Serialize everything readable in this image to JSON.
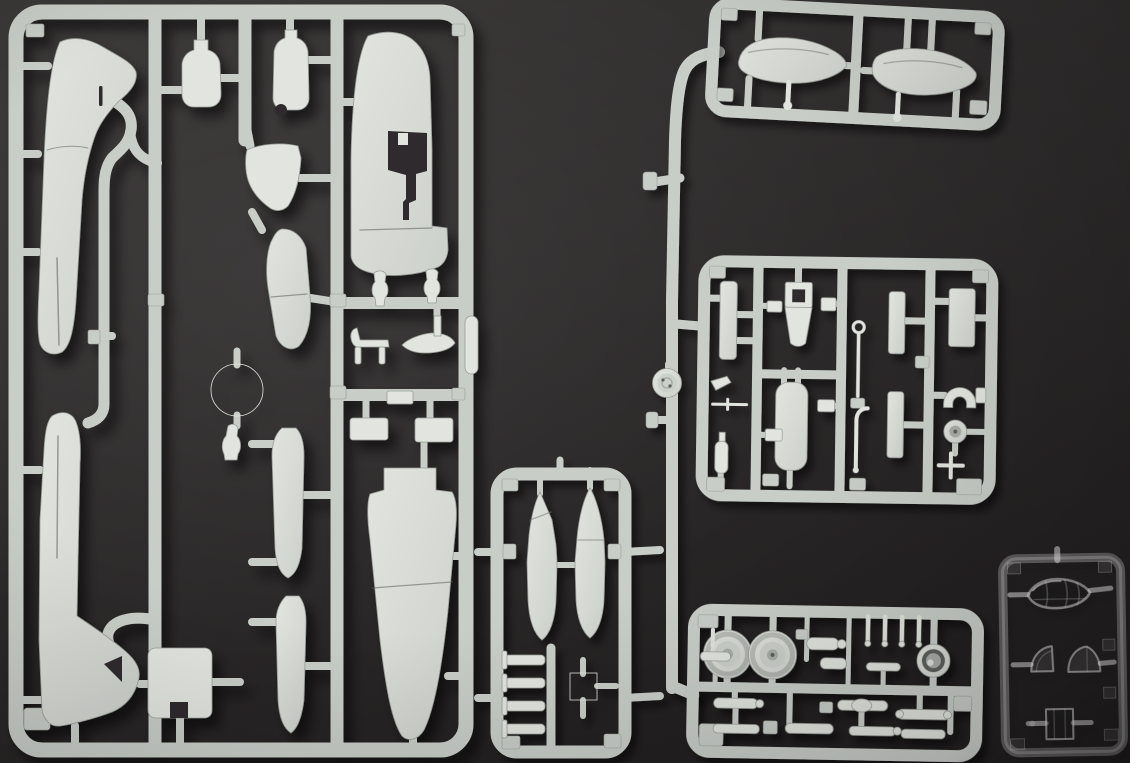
{
  "image": {
    "kind": "photograph",
    "alt": "Five grey injection-moulded model aircraft sprues and one clear-parts sprue arranged on a dark charcoal background",
    "description": "Top-down photo of an unbuilt plastic aircraft model kit: a large grey sprue with fuselage, wing and tail halves; a small ordnance sprue with two bomb halves; a tilted sprue with two drop-tank halves; a cockpit-detail sprue; an undercarriage sprue with wheels; and a small transparent sprue with canopy and window parts, all joined by pale grey runners that cast soft shadows."
  },
  "palette": {
    "background_top": "#3a3737",
    "background_bottom": "#232021",
    "plastic": "#c9cdc8",
    "plastic_light": "#e2e4df",
    "plastic_mid": "#ccd0cb",
    "plastic_dark": "#b4b8b3",
    "plastic_edge": "#989d98",
    "recess": "#2e2c2d",
    "hub_dark": "#5d605c",
    "hub_mid": "#a9ada8",
    "clear_edge": "rgba(255,255,255,0.48)",
    "clear_soft": "rgba(255,255,255,0.22)",
    "clear_face": "rgba(255,255,255,0.07)"
  },
  "sprues": [
    {
      "id": "A",
      "label": "main airframe sprue",
      "material": "grey styrene",
      "parts": [
        "wing half with hooked tip",
        "wing half with root triangle",
        "upper wing skin with keyhole wheel-well cutout",
        "large tapered wing skin",
        "two exhaust-cover flasks",
        "cowl side panel",
        "tailplane blade",
        "engine cowling ring",
        "small baluster strut",
        "two slim underwing pod halves",
        "tail skid",
        "small float with pylon",
        "capsule fairing",
        "access hatch with notch",
        "three small panel plates",
        "two pawn-shaped struts"
      ]
    },
    {
      "id": "B",
      "label": "ordnance sprue",
      "material": "grey styrene",
      "parts": [
        "bomb half with angled nose face",
        "bomb half with conical nose",
        "four small rod bombs",
        "square frame sight"
      ]
    },
    {
      "id": "C",
      "label": "drop tank sprue",
      "material": "grey styrene",
      "parts": [
        "streamlined tank half (left)",
        "streamlined tank half (right)",
        "two teardrop pins"
      ]
    },
    {
      "id": "D",
      "label": "cockpit detail sprue",
      "material": "grey styrene",
      "parts": [
        "instrument panel strip",
        "pilot seat with square opening",
        "seat back",
        "cockpit floor tub",
        "ring-topped control stick",
        "bent lever",
        "headrest horseshoe",
        "small tail wheel",
        "bulkhead plate",
        "two narrow side panels",
        "assorted boxes, bottle and pitot"
      ]
    },
    {
      "id": "E",
      "label": "undercarriage sprue",
      "material": "grey styrene",
      "parts": [
        "main wheel (left)",
        "main wheel (right)",
        "deep-hub wheel / cowling front",
        "four small pins",
        "T-shaped brace",
        "eight undercarriage legs and struts"
      ]
    },
    {
      "id": "F",
      "label": "clear parts sprue",
      "material": "transparent styrene",
      "parts": [
        "bubble canopy with frame lines",
        "quarter windscreen",
        "rear glazing dome",
        "square window block"
      ]
    }
  ],
  "connectors": {
    "long_runner": "vertical feed runner linking the drop tank, cockpit and undercarriage sprues",
    "disc_part": "hub-cap disc moulded directly on the feed runner"
  }
}
